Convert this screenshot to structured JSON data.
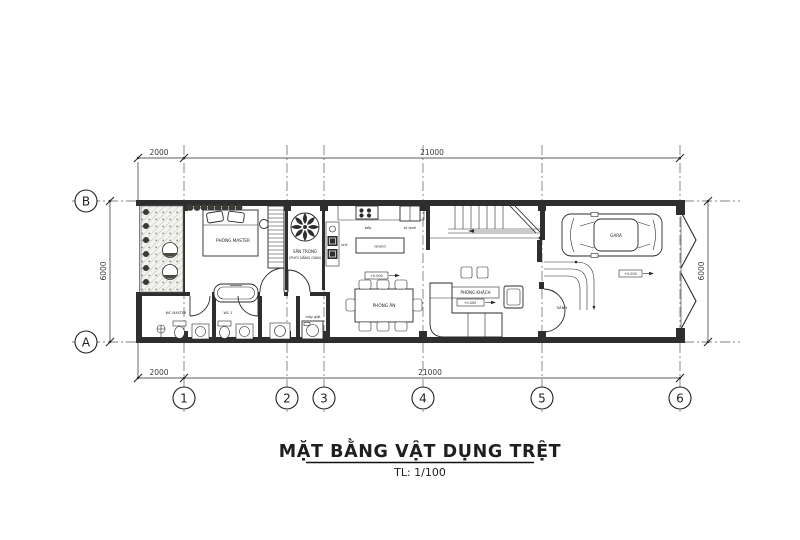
{
  "title": {
    "main": "MẶT BẰNG VẬT DỤNG TRỆT",
    "scale": "TL: 1/100"
  },
  "dims": {
    "top_left": "2000",
    "top_main": "21000",
    "bottom_left": "2000",
    "bottom_main": "21000",
    "left_height": "6000",
    "right_height": "6000"
  },
  "grid": {
    "c1": "1",
    "c2": "2",
    "c3": "3",
    "c4": "4",
    "c5": "5",
    "c6": "6",
    "rA": "A",
    "rB": "B"
  },
  "labels": {
    "master_bedroom": "PHÒNG MASTER",
    "courtyard_1": "SÂN TRONG",
    "courtyard_2": "(PHƠI NẮNG GIAN)",
    "stove": "bếp",
    "fridge": "tủ lạnh",
    "island": "island",
    "sink": "sink",
    "dining": "PHÒNG ĂN",
    "living": "PHÒNG KHÁCH",
    "hall": "SẢNH",
    "garage_car": "GARA",
    "wc_master": "WC MASTER",
    "wc1": "WC 1",
    "laundry": "máy giặt",
    "level_dining": "+0.000",
    "level_living": "+0.000",
    "level_garage": "+0.000"
  },
  "colors": {
    "paper": "#ffffff",
    "line": "#2a2a2a",
    "wall": "#2e2e2e",
    "grid": "#5a5a5a"
  }
}
